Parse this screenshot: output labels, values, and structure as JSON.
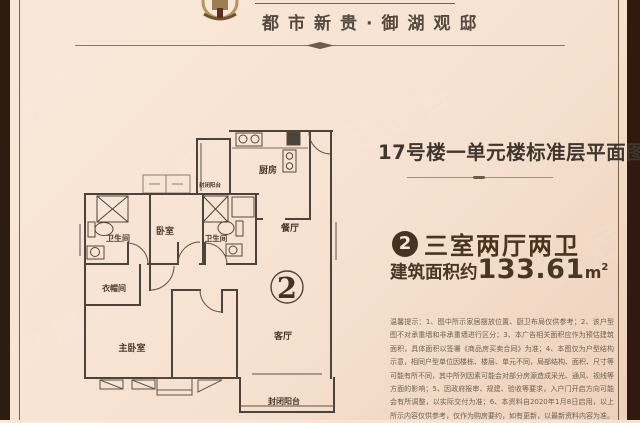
{
  "header": {
    "title": "都市新贵·御湖观邸"
  },
  "panel": {
    "plan_title": "17号楼一单元楼标准层平面图",
    "unit_badge": "2",
    "unit_type": "三室两厅两卫",
    "area_label": "建筑面积约",
    "area_value": "133.61",
    "area_unit": "m",
    "area_power": "2",
    "disclaimer": "温馨提示：1、图中所示家居摆放位置、厨卫布局仅供参考；2、该户型图不对承重墙和非承重墙进行区分；3、本广告相关面积应作为预估建筑面积，具体面积以签署《商品房买卖合同》为准；4、本图仅为户型结构示意，相同户型单位因楼栋、楼层、单元不同，局部结构、面积、尺寸等可能有所不同，其中所列因素可能会对部分房源造成采光、通风、视线等方面的影响；5、因政府报审、规建、验收等要求，入户门开启方向可能会有所调整，以实际交付为准；6、本资料自2020年1月8日启用，以上所示内容仅供参考，仅作为购房要约，如有更新，以最新资料内容为准。"
  },
  "floor_plan": {
    "unit_number": "2",
    "rooms": {
      "kitchen": "厨房",
      "balcony_top": "封闭阳台",
      "bath_left": "卫生间",
      "bedroom": "卧室",
      "bath_mid": "卫生间",
      "dining": "餐厅",
      "cloakroom": "衣帽间",
      "master_bedroom": "主卧室",
      "living": "客厅",
      "balcony_bottom": "封闭阳台"
    }
  },
  "watermark": {
    "text": "安居客"
  },
  "colors": {
    "background": "#f7e2d1",
    "frame_bar": "#2d1c10",
    "accent_brown": "#49341f",
    "wall": "#4c433b",
    "divider": "#8d7a64"
  }
}
